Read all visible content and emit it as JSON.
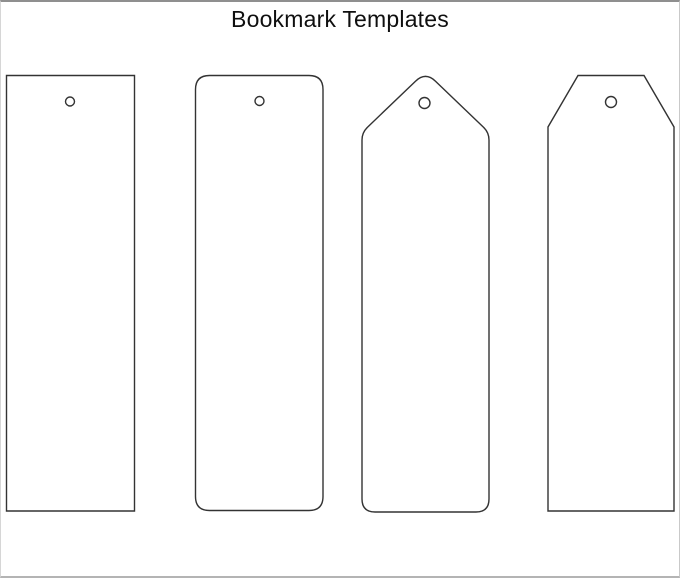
{
  "title": "Bookmark Templates",
  "canvas": {
    "width": 680,
    "height": 578,
    "background": "#ffffff",
    "border_top_color": "#8f8f8f",
    "border_side_color": "#cfcfcf",
    "border_bottom_color": "#b4b4b4",
    "outline_color": "#333333",
    "outline_width": 1.4,
    "shape_fill": "#ffffff"
  },
  "bookmarks": [
    {
      "name": "bookmark-rectangle",
      "shape": "rectangle",
      "path": "M 5.5 73.5 L 133.5 73.5 L 133.5 509 L 5.5 509 Z",
      "hole": {
        "cx": 69,
        "cy": 99.5,
        "r": 4.5
      }
    },
    {
      "name": "bookmark-rounded-rectangle",
      "shape": "rounded-rectangle",
      "path": "M 208.5 73.5 L 308 73.5 Q 322 73.5 322 87.5 L 322 494.5 Q 322 508.5 308 508.5 L 208.5 508.5 Q 194.5 508.5 194.5 494.5 L 194.5 87.5 Q 194.5 73.5 208.5 73.5 Z",
      "hole": {
        "cx": 258.5,
        "cy": 99,
        "r": 4.5
      }
    },
    {
      "name": "bookmark-pointed-top",
      "shape": "pointed-top-rounded-bottom",
      "path": "M 361 497 L 361 138 Q 361 130.5 366.5 125.2 L 414.5 79.2 Q 424.5 69.6 434.5 79.2 L 482.5 125.2 Q 488 130.5 488 138 L 488 497 Q 488 510 475 510 L 374 510 Q 361 510 361 497 Z",
      "hole": {
        "cx": 423.5,
        "cy": 101,
        "r": 5.5
      }
    },
    {
      "name": "bookmark-chamfered-top",
      "shape": "chamfered-top",
      "path": "M 577 73.5 L 643 73.5 L 673 125 L 673 509 L 547 509 L 547 125 Z",
      "hole": {
        "cx": 610,
        "cy": 100,
        "r": 5.5
      }
    }
  ]
}
